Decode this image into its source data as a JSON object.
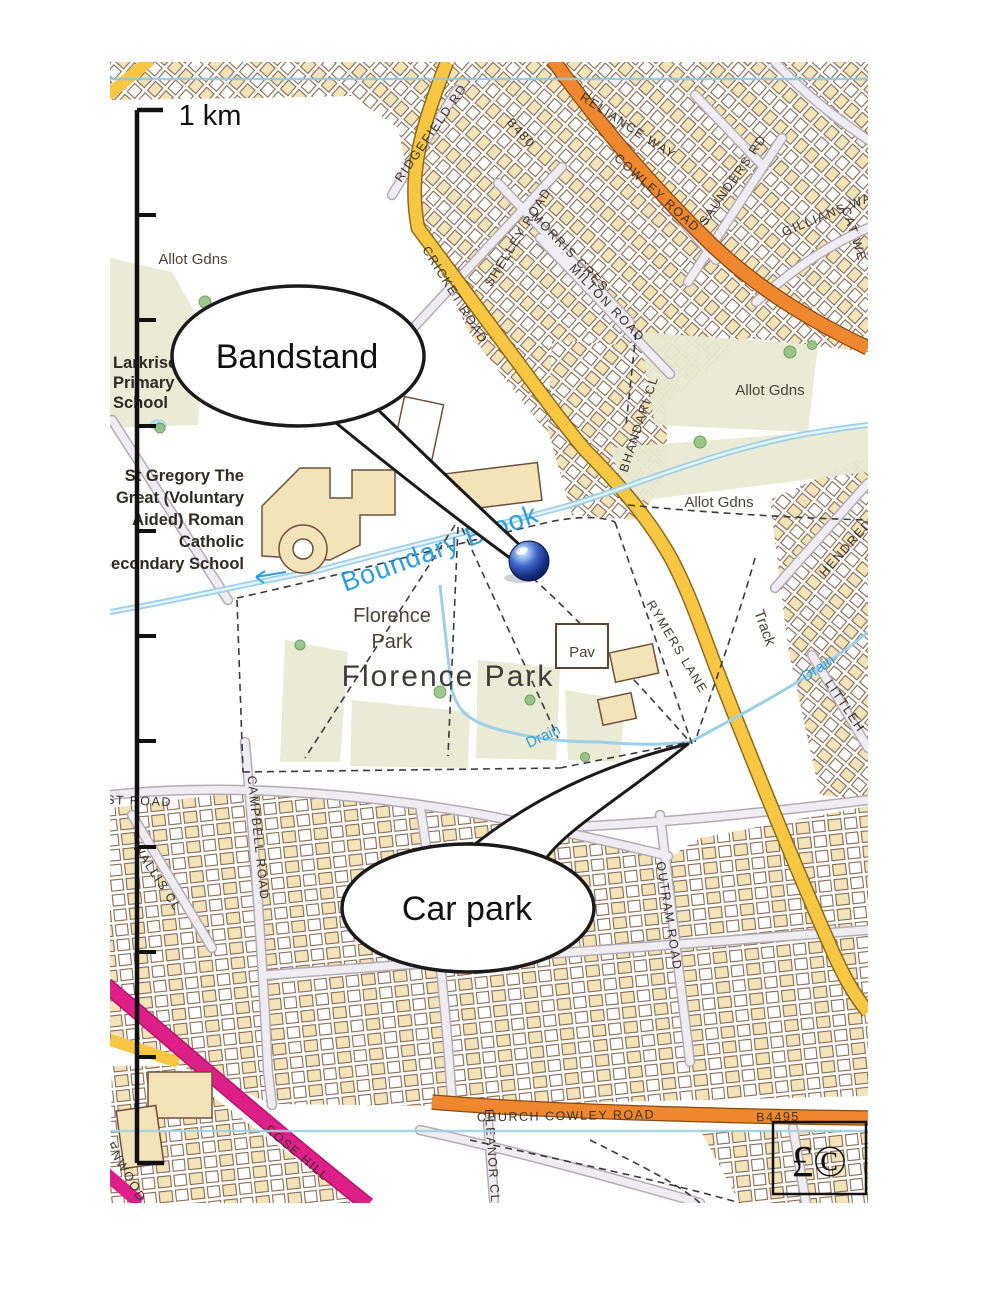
{
  "scale_bar": {
    "label": "1 km"
  },
  "callouts": {
    "bandstand": {
      "label": "Bandstand"
    },
    "car_park": {
      "label": "Car park"
    }
  },
  "copyright": {
    "symbol": "£©"
  },
  "marker": {
    "type": "blue-sphere-pin",
    "color": "#1B3F8F"
  },
  "places": {
    "allot_gdns": "Allot Gdns",
    "larkrise_line1": "Larkrise",
    "larkrise_line2": "Primary",
    "larkrise_line3": "School",
    "st_gregory_line1": "St Gregory The",
    "st_gregory_line2": "Great (Voluntary",
    "st_gregory_line3": "Aided) Roman",
    "st_gregory_line4": "Catholic",
    "st_gregory_line5": "Secondary School",
    "florence_park_line1": "Florence",
    "florence_park_line2": "Park",
    "florence_park_large": "Florence Park",
    "pav": "Pav",
    "track": "Track",
    "drain": "Drain",
    "boundary_brook": "Boundary Brook"
  },
  "roads": {
    "ridgefield": "RIDGEFIELD RD",
    "shelley": "SHELLEY ROAD",
    "morris": "MORRIS CRES",
    "milton": "MILTON ROAD",
    "b480": "B480",
    "reliance": "RELIANCE WAY",
    "cowley": "COWLEY ROAD",
    "saunders": "SAUNDERS RD",
    "gillians": "GILLIANS WAY",
    "cat_we": "CAT WE",
    "cricket": "CRICKET ROAD",
    "bhandari": "BHANDARI CL",
    "rymers": "RYMERS LANE",
    "hendred": "HENDRED",
    "littlehay": "LITTLEH",
    "campbell": "CAMPBELL ROAD",
    "wallis": "WALLIS CL",
    "st_road": "ST ROAD",
    "outram": "OUTRAM ROAD",
    "church_cowley": "CHURCH COWLEY ROAD",
    "b4495": "B4495",
    "rose_hill": "ROSE HILL",
    "eleanor": "ELEANOR CL",
    "enwood": "ENWOOD"
  },
  "colors": {
    "main_road_orange": "#EE872D",
    "secondary_road_yellow": "#F7C743",
    "primary_route_pink": "#DE1F87",
    "water_blue": "#9CCFE8",
    "water_label_blue": "#2D9CDB",
    "building_tan": "#F2E3B8",
    "green_area": "#E8EAD2",
    "marker_blue": "#1B3F8F"
  }
}
